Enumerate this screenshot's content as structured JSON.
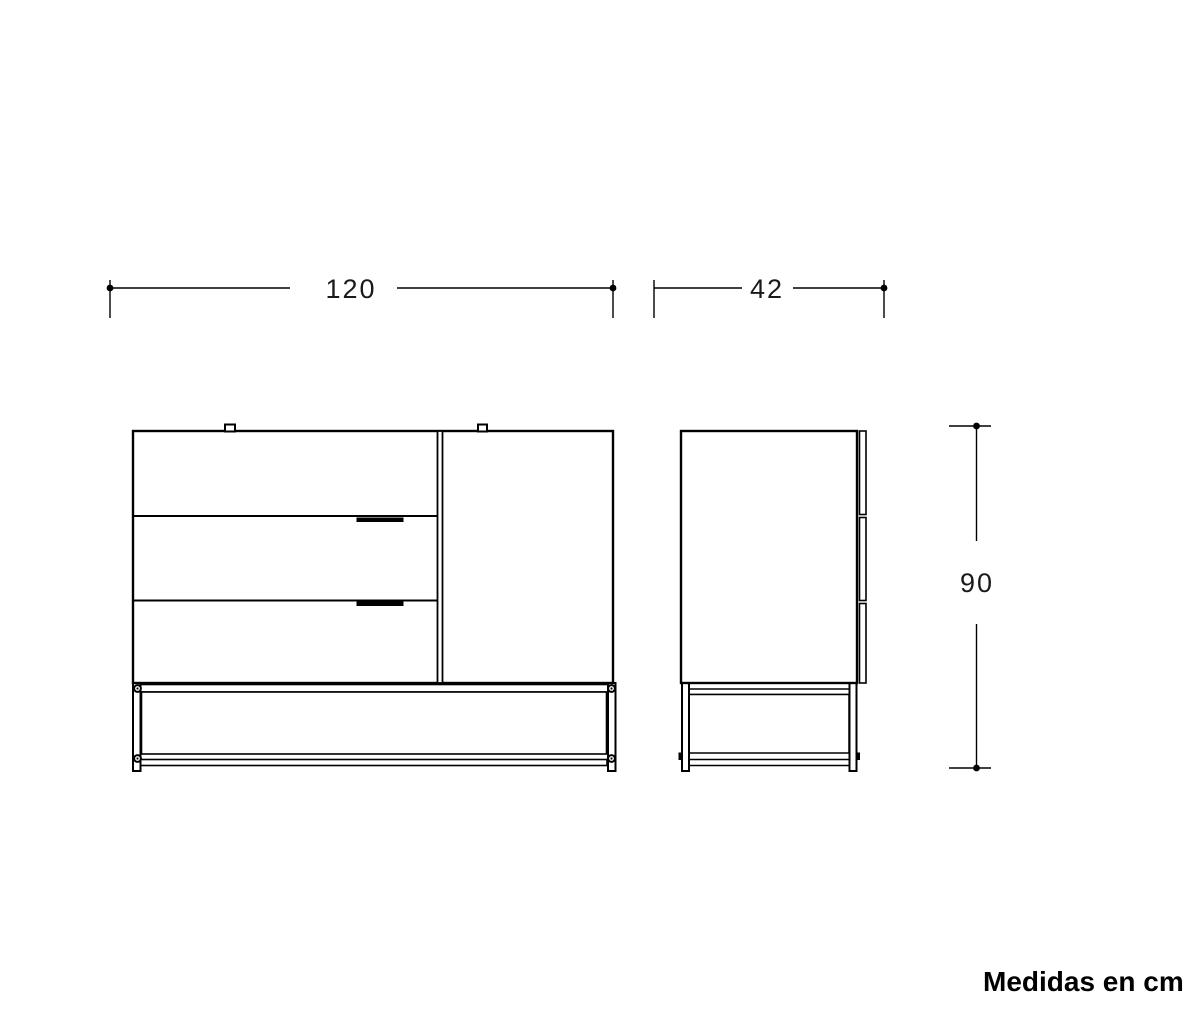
{
  "dimensions": {
    "width": "120",
    "depth": "42",
    "height": "90",
    "unit_note": "Medidas en cm"
  },
  "colors": {
    "line": "#000000",
    "background": "#ffffff",
    "text": "#1a1a1a"
  }
}
